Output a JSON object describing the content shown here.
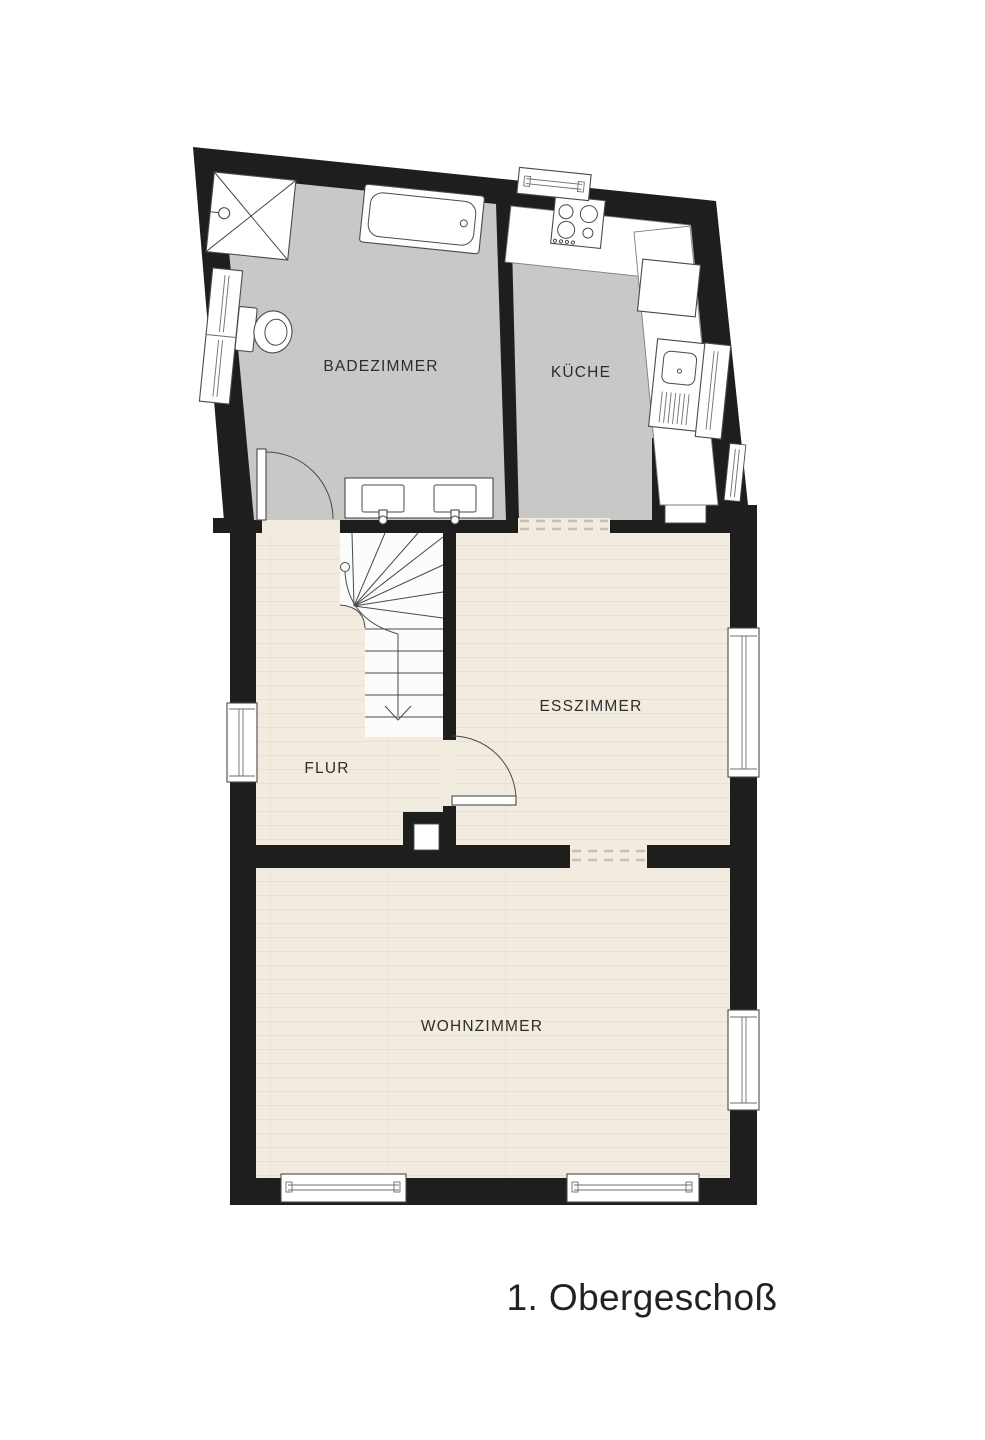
{
  "plan": {
    "title": "1. Obergeschoß",
    "rooms": [
      {
        "id": "badezimmer",
        "label": "BADEZIMMER"
      },
      {
        "id": "kueche",
        "label": "KÜCHE"
      },
      {
        "id": "flur",
        "label": "FLUR"
      },
      {
        "id": "esszimmer",
        "label": "ESSZIMMER"
      },
      {
        "id": "wohnzimmer",
        "label": "WOHNZIMMER"
      }
    ],
    "colors": {
      "wall": "#1e1e1c",
      "tile_floor": "#c8c8c7",
      "wood_floor": "#f2ebdf",
      "background": "#ffffff",
      "label_text": "#2d2d2d",
      "title_text": "#222222"
    }
  }
}
